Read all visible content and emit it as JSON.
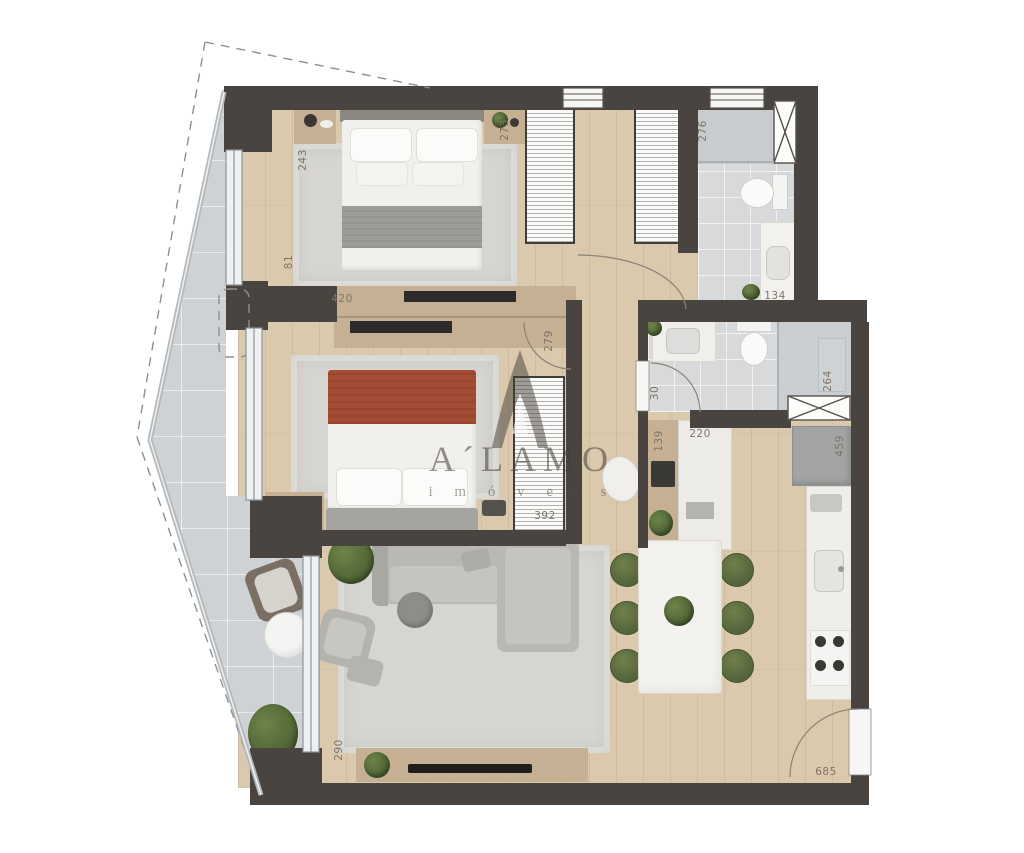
{
  "watermark": {
    "brand": "A´LAMO",
    "subtitle": "i m ó v e i s"
  },
  "dimensions": {
    "bedroom1_depth": "243",
    "bedroom1_closet": "273",
    "bedroom1_window": "81",
    "bedroom1_width": "420",
    "bathroom1_depth": "276",
    "bathroom1_width": "134",
    "hall_door": "279",
    "bathroom2_door": "30",
    "bathroom2_shower": "264",
    "desk_depth": "139",
    "desk_width": "220",
    "kitchen_depth": "459",
    "bedroom2_wardrobe": "392",
    "living_window": "290",
    "entry_width": "685"
  },
  "colors": {
    "wall": "#4a4440",
    "wood_floor": "#dbc9ad",
    "balcony_tile": "#ced2d5",
    "bath_tile": "#d7d9db",
    "chair_green": "#5d6c3e",
    "bed_throw_red": "#a34b33",
    "watermark_gray": "#46403a"
  }
}
